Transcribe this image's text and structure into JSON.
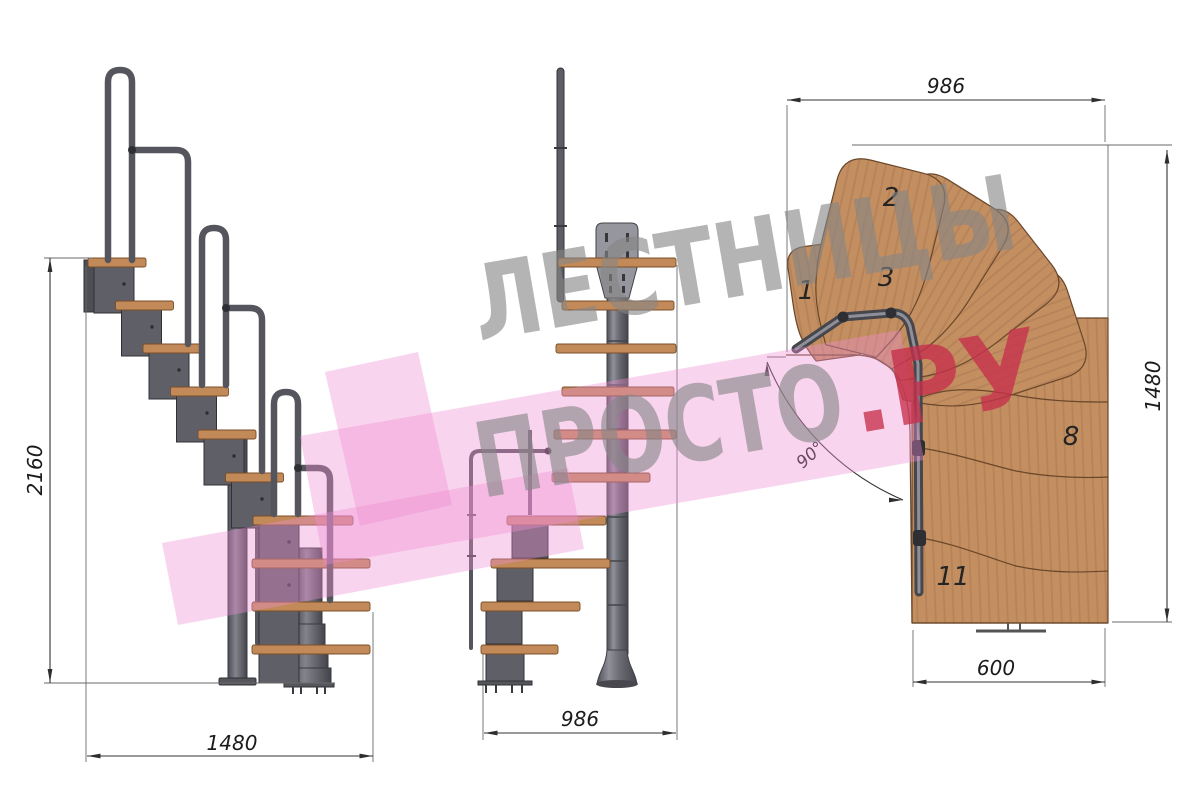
{
  "drawing": {
    "subject": "modular-staircase-three-views",
    "watermark": {
      "line1": "ЛЕСТНИЦЫ",
      "line2": "ПРОСТО",
      "line2_suffix": ".РУ"
    },
    "views": {
      "side": {
        "height_mm": "2160",
        "width_mm": "1480"
      },
      "front": {
        "width_mm": "986"
      },
      "plan": {
        "width_mm": "986",
        "depth_mm": "1480",
        "exit_width_mm": "600",
        "turn_angle": "90°",
        "step_labels": [
          "1",
          "2",
          "3",
          "8",
          "11"
        ]
      }
    },
    "colors": {
      "wood": "#c28a59",
      "metal": "#5f5f67",
      "handrail": "#55555d",
      "dimension": "#2e2e2e",
      "watermark_gray": "#868686",
      "watermark_red": "#c6304c",
      "watermark_pink": "#ee8fd2"
    }
  }
}
